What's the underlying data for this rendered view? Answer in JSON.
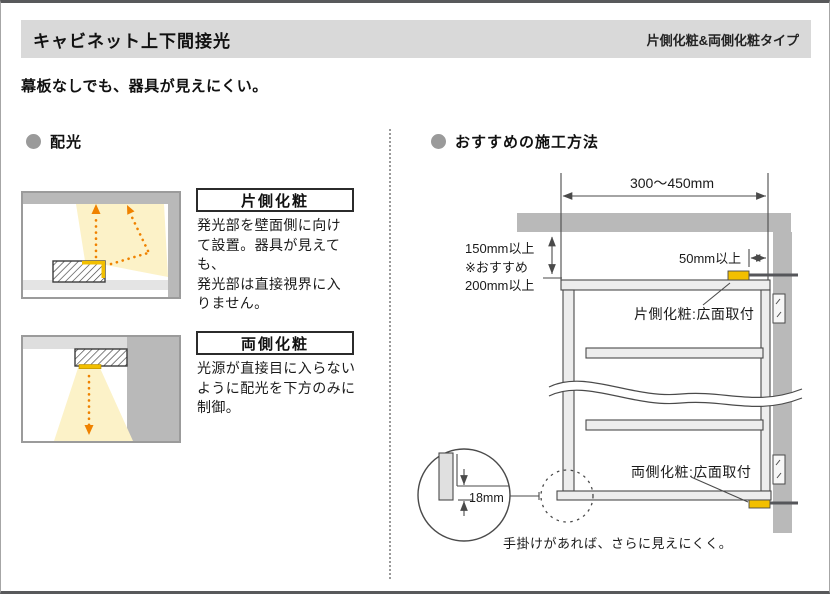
{
  "header": {
    "title": "キャビネット上下間接光",
    "type_label": "片側化粧&両側化粧タイプ"
  },
  "subtitle": "幕板なしでも、器具が見えにくい。",
  "left_section": {
    "heading": "配光",
    "items": [
      {
        "label": "片側化粧",
        "description": [
          "発光部を壁面側に向け",
          "て設置。器具が見えても、",
          "発光部は直接視界に入",
          "りません。"
        ]
      },
      {
        "label": "両側化粧",
        "description": [
          "光源が直接目に入らない",
          "ように配光を下方のみに",
          "制御。"
        ]
      }
    ]
  },
  "right_section": {
    "heading": "おすすめの施工方法",
    "dimensions": {
      "width_range": "300〜450mm",
      "height_block": [
        "150mm以上",
        "※おすすめ",
        "200mm以上"
      ],
      "side_gap": "50mm以上",
      "handle_depth": "18mm"
    },
    "labels": {
      "top_fixture": "片側化粧:広面取付",
      "bottom_fixture": "両側化粧:広面取付",
      "handle_note": "手掛けがあれば、さらに見えにくく。"
    }
  },
  "colors": {
    "header_bar": "#d9d9d9",
    "structure_gray": "#b9b9b9",
    "light_accent_orange": "#ef8200",
    "fixture_yellow": "#f2bf00",
    "light_cone": "#fcf2c8",
    "page_rule": "#58595b"
  },
  "icons": {
    "section_bullet": "circle"
  }
}
